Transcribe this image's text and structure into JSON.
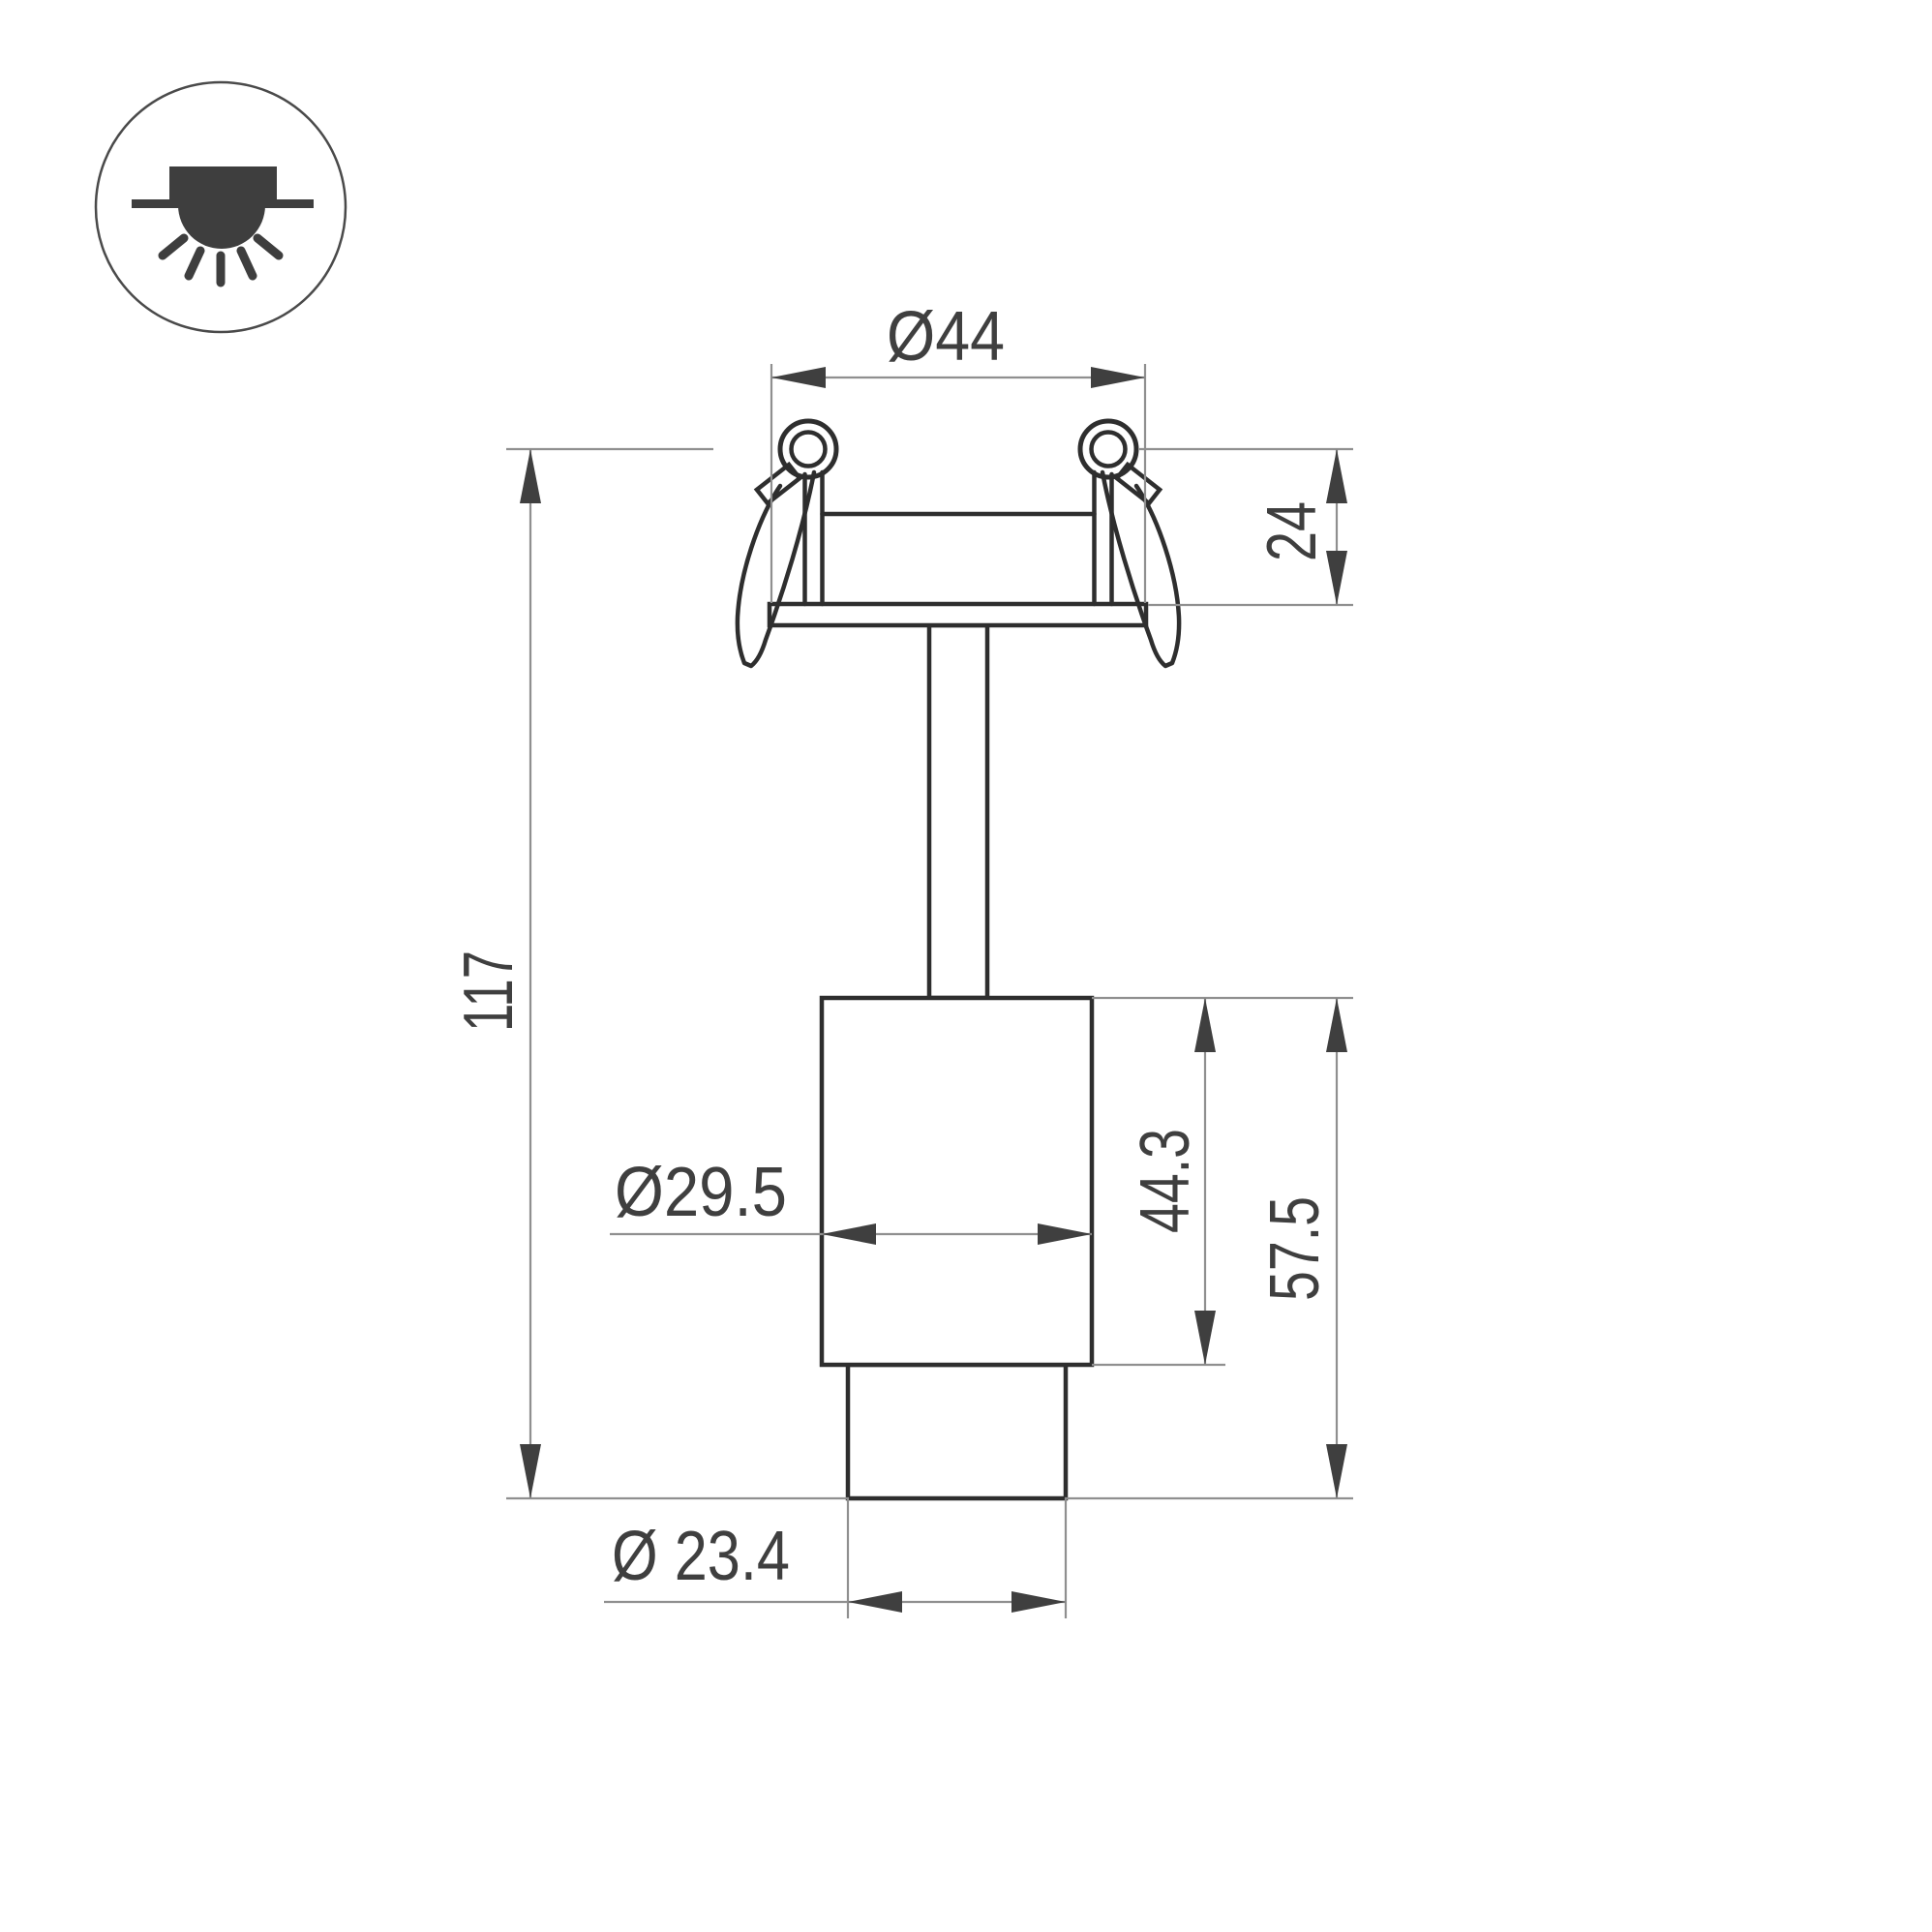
{
  "legend_icon": {
    "name": "recessed-downlight-mount-icon"
  },
  "dimensions": {
    "cutout_diameter": "Ø44",
    "recess_depth": "24",
    "overall_height": "117",
    "body_diameter": "Ø29.5",
    "body_height": "44.3",
    "lower_section_height": "57.5",
    "tube_diameter": "Ø 23.4"
  },
  "colors": {
    "outline": "#2e2e2e",
    "dimension_line": "#8f8f8f",
    "annotation": "#3f3f3f",
    "icon_fill": "#3e3e3e",
    "background": "#ffffff"
  }
}
